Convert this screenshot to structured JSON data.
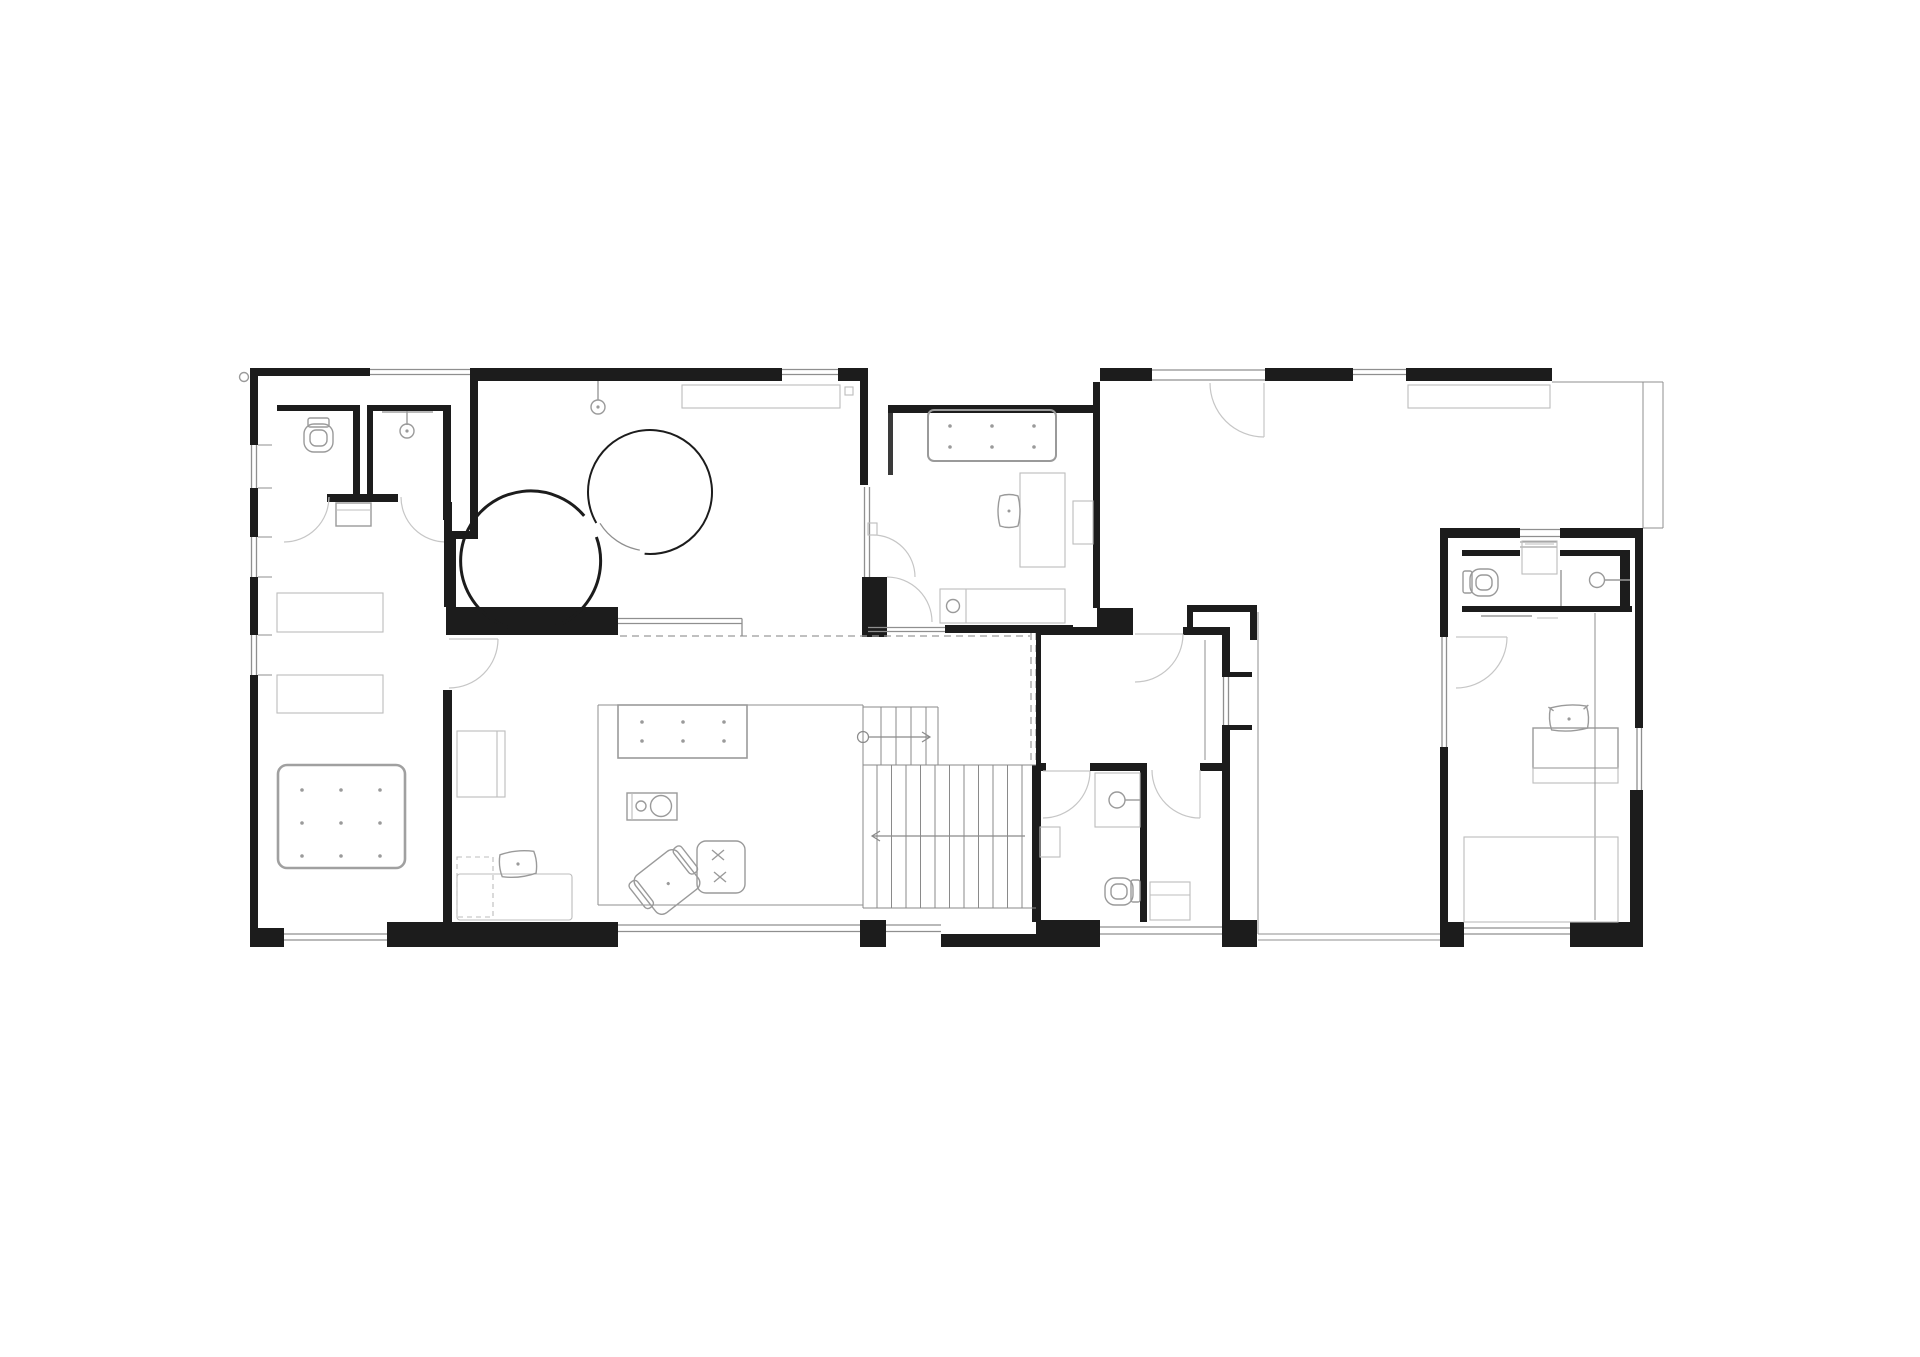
{
  "canvas": {
    "background": "#ffffff"
  },
  "colors": {
    "background": "#ffffff",
    "wall": "#1c1c1c",
    "wall-light": "#3a3a3a",
    "glazing": "#8f8f8f",
    "furniture": "#9a9a9a",
    "furniture-light": "#bcbcbc",
    "bed": "#a0a0a0",
    "door": "#c6c6c6",
    "dash": "#9a9a9a",
    "tread": "#8a8a8a"
  },
  "floor_plan": {
    "type": "architectural-floor-plan",
    "fixtures": [
      "toilet-wc-top-left",
      "pendant-light-shower-room",
      "pendant-light-round-room",
      "circular-stair-enclosure",
      "wardrobe-shelves-left-room",
      "double-bed-bottom-left",
      "daybed-with-pillow",
      "kitchen-island-with-stools",
      "cooktop-sink-unit",
      "lounge-armchair",
      "ottoman-stitched",
      "staircase-with-direction-arrows",
      "bed-middle-bedroom",
      "desk-and-chair-middle-bedroom",
      "dresser-with-basin-middle-bedroom",
      "vanity-sink-center-bathroom",
      "toilet-center-bathroom",
      "shower-center-bathroom",
      "desk-study-room",
      "toilet-right-wing-bathroom",
      "sink-right-wing-bathroom",
      "entry-mat-right-wing",
      "bed-with-pillow-right-wing",
      "wardrobe-right-wing",
      "sideboard-top-right-room",
      "roof-void-dashed-line",
      "terrace-outline",
      "patio-edge-line",
      "downspout-marker"
    ]
  }
}
